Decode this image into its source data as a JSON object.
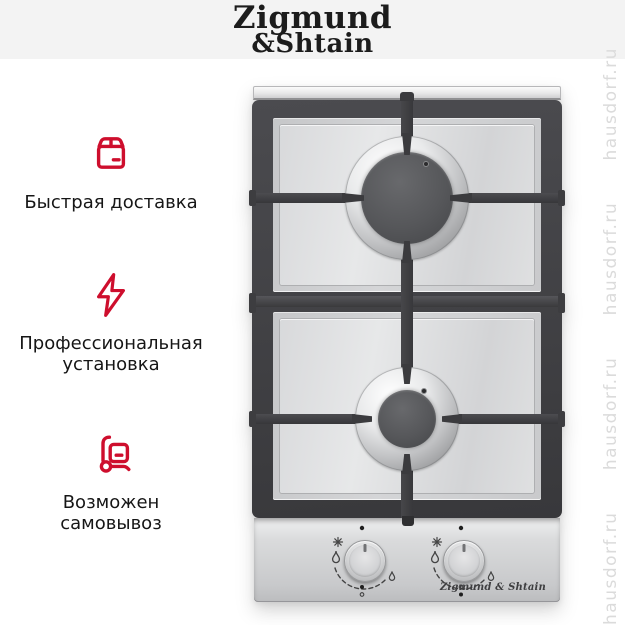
{
  "header": {
    "brand_line1": "Zigmund",
    "brand_line2": "&Shtain"
  },
  "features": [
    {
      "icon": "package-icon",
      "label": "Быстрая доставка"
    },
    {
      "icon": "lightning-icon",
      "label": "Профессиональная установка"
    },
    {
      "icon": "handtruck-icon",
      "label": "Возможен самовывоз"
    }
  ],
  "product": {
    "type": "2-burner gas hob, stainless steel with cast-iron grates",
    "burner_count": 2,
    "knob_count": 2,
    "brand_badge": "Zigmund & Shtain"
  },
  "watermark": {
    "text": "hausdorf.ru",
    "repeated": "hausdorf.ru      hausdorf.ru      hausdorf.ru      hausdorf.ru"
  },
  "colors": {
    "accent_red": "#ce0e2d",
    "header_band": "#f3f3f3",
    "text_dark": "#161616",
    "watermark_gray": "#dbdbdb",
    "grate_dark": "#3f4043"
  }
}
